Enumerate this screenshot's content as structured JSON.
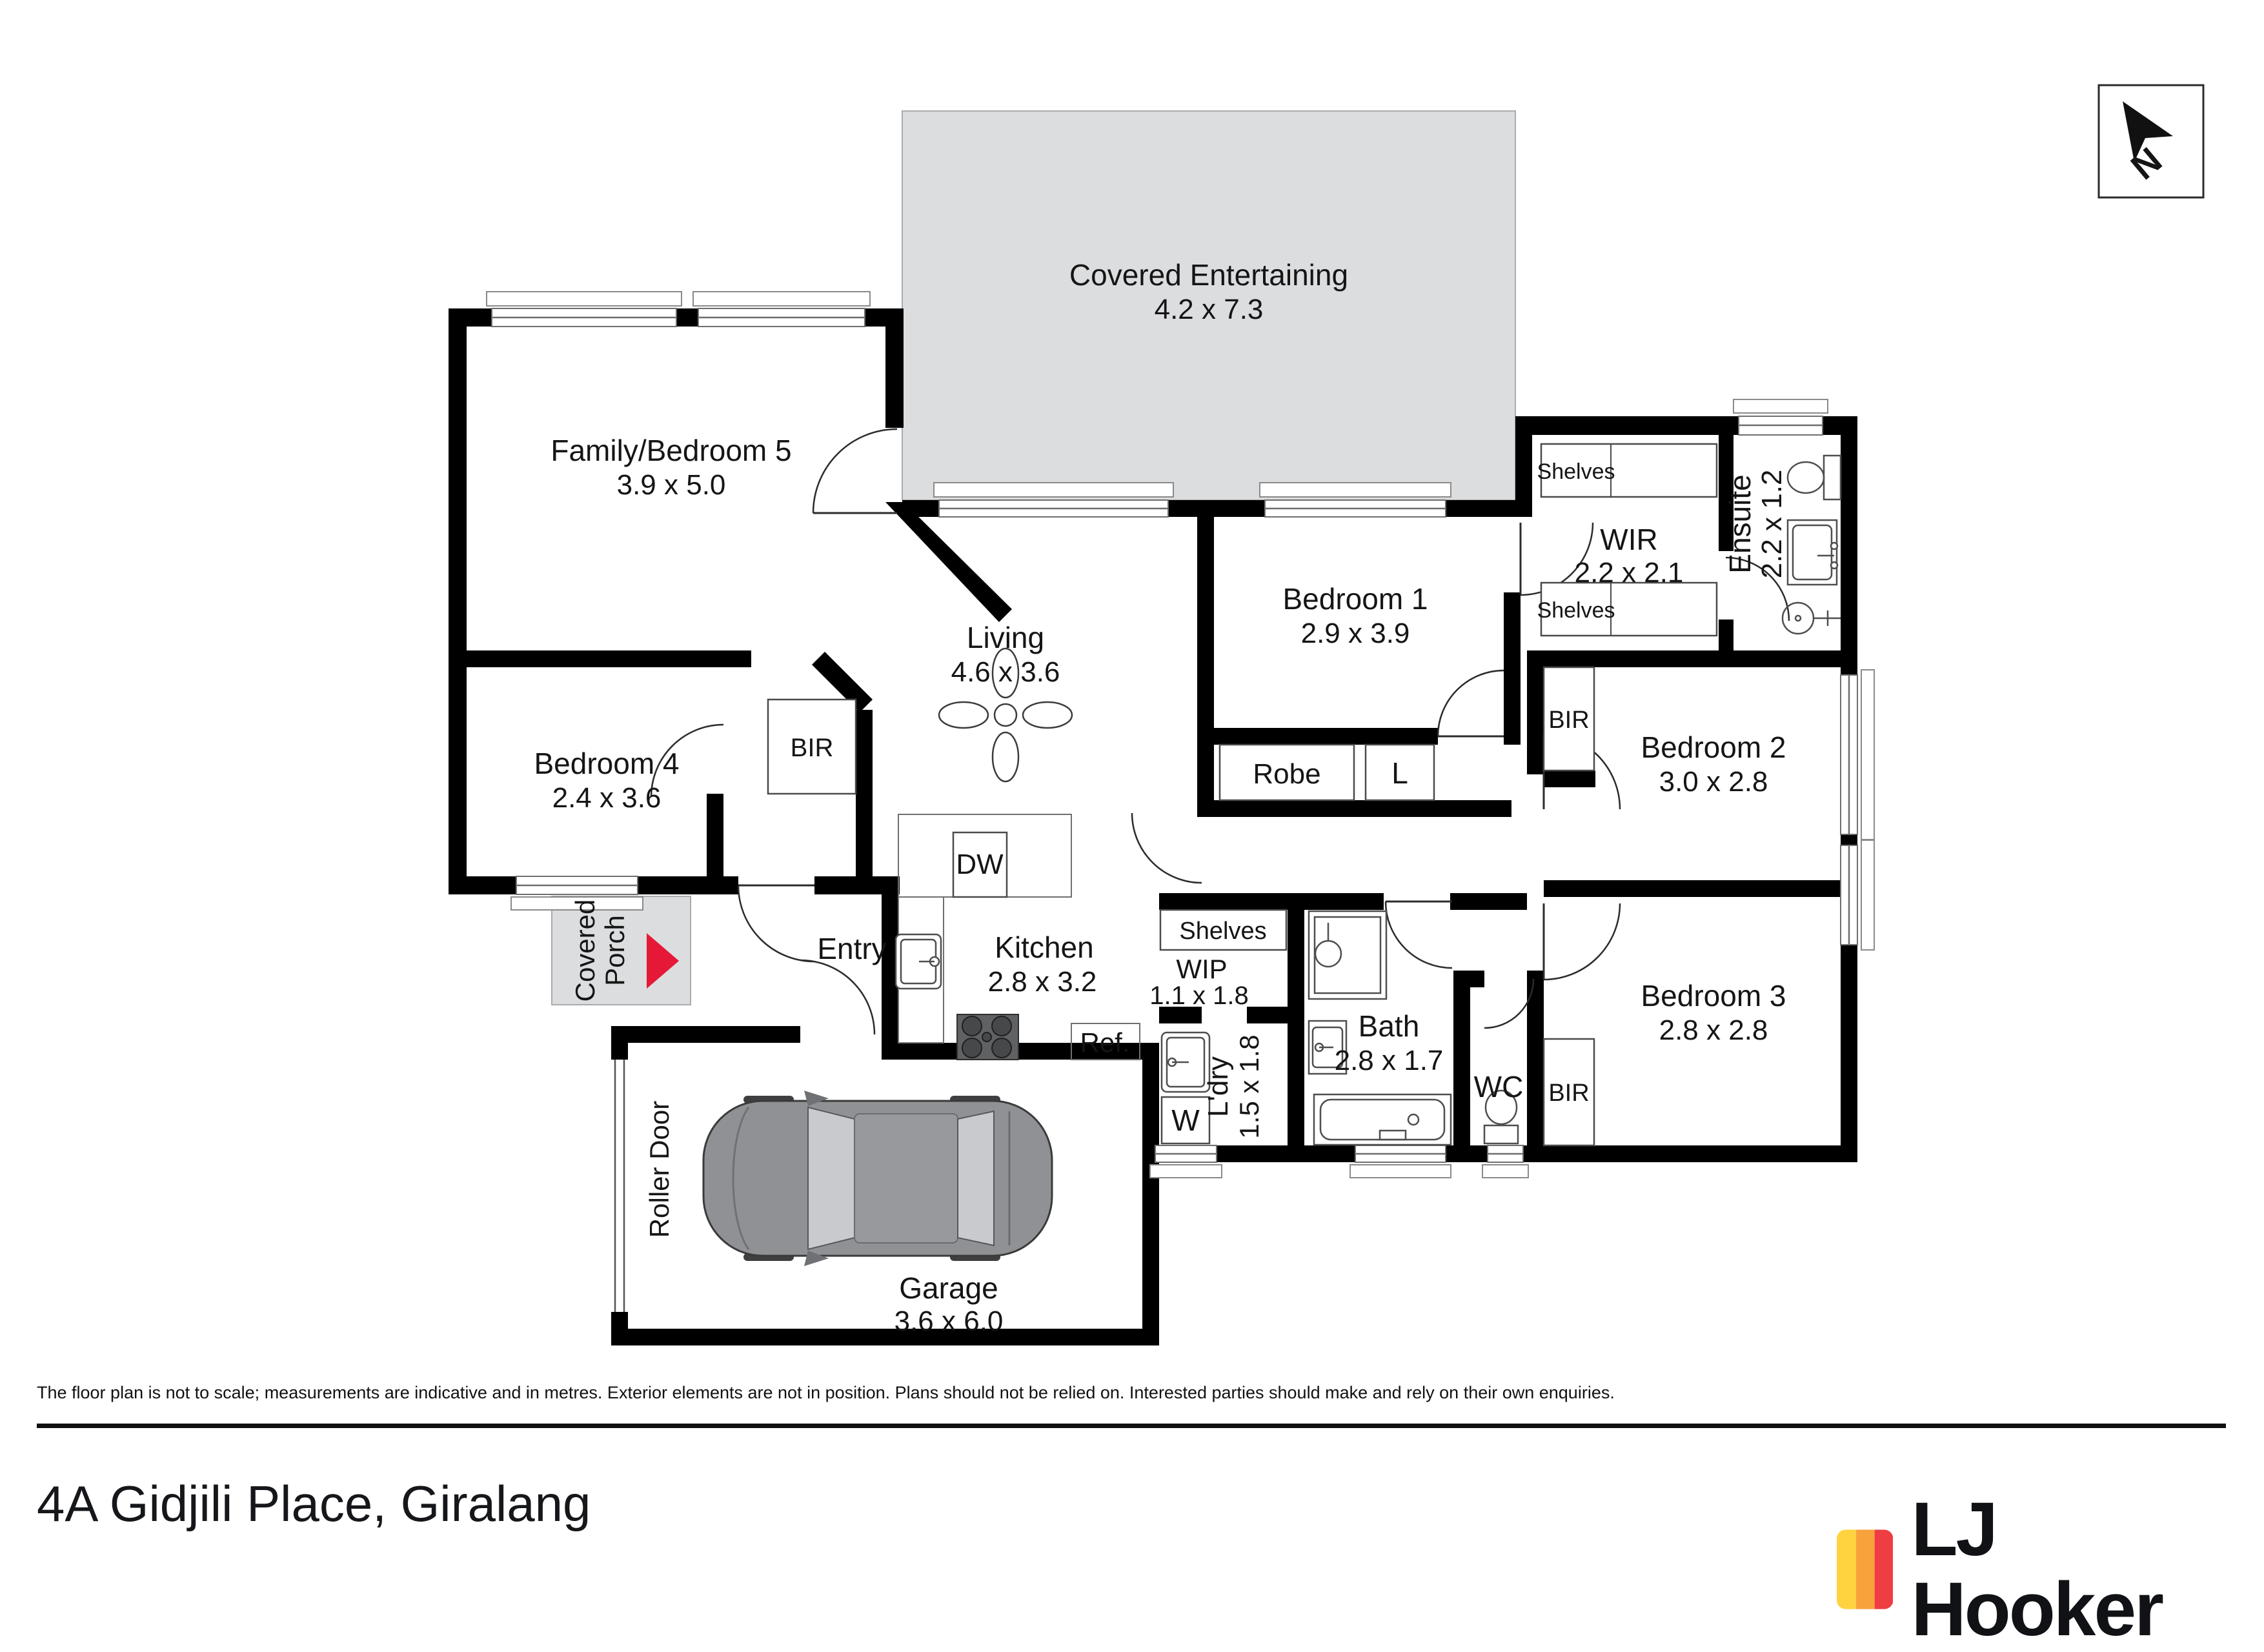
{
  "north": {
    "label": "N"
  },
  "rooms": {
    "covered_entertaining": {
      "name": "Covered Entertaining",
      "dims": "4.2 x 7.3"
    },
    "family_bedroom5": {
      "name": "Family/Bedroom 5",
      "dims": "3.9 x 5.0"
    },
    "bedroom4": {
      "name": "Bedroom 4",
      "dims": "2.4 x 3.6"
    },
    "living": {
      "name": "Living",
      "dims": "4.6 x 3.6"
    },
    "bedroom1": {
      "name": "Bedroom 1",
      "dims": "2.9 x 3.9"
    },
    "wir": {
      "name": "WIR",
      "dims": "2.2 x 2.1"
    },
    "ensuite": {
      "name": "Ensuite",
      "dims": "2.2 x 1.2"
    },
    "bedroom2": {
      "name": "Bedroom 2",
      "dims": "3.0 x 2.8"
    },
    "bedroom3": {
      "name": "Bedroom 3",
      "dims": "2.8 x 2.8"
    },
    "kitchen": {
      "name": "Kitchen",
      "dims": "2.8 x 3.2"
    },
    "wip": {
      "name": "WIP",
      "dims": "1.1 x 1.8"
    },
    "laundry": {
      "name": "L'dry",
      "dims": "1.5 x 1.8"
    },
    "bath": {
      "name": "Bath",
      "dims": "2.8 x 1.7"
    },
    "wc": {
      "name": "WC"
    },
    "entry": {
      "name": "Entry"
    },
    "garage": {
      "name": "Garage",
      "dims": "3.6 x 6.0"
    },
    "covered_porch": {
      "line1": "Covered",
      "line2": "Porch"
    },
    "roller_door": {
      "name": "Roller Door"
    }
  },
  "labels": {
    "robe": "Robe",
    "linen": "L",
    "bir": "BIR",
    "shelves": "Shelves",
    "dw": "DW",
    "ref": "Ref.",
    "washer": "W"
  },
  "colors": {
    "covered_area": "#DCDDDE",
    "porch_arrow": "#E51937",
    "wall": "#000000",
    "car_body": "#8F9194",
    "car_glass": "#C9CACD"
  },
  "brand": {
    "name": "LJ Hooker",
    "stripe_colors": [
      "#FFD23F",
      "#F7A23B",
      "#EE3E43"
    ]
  },
  "footer": {
    "disclaimer": "The floor plan is not to scale; measurements are indicative and in metres. Exterior elements are not in position. Plans should not be relied on. Interested parties should make and rely on their own enquiries.",
    "address": "4A Gidjili Place, Giralang"
  }
}
